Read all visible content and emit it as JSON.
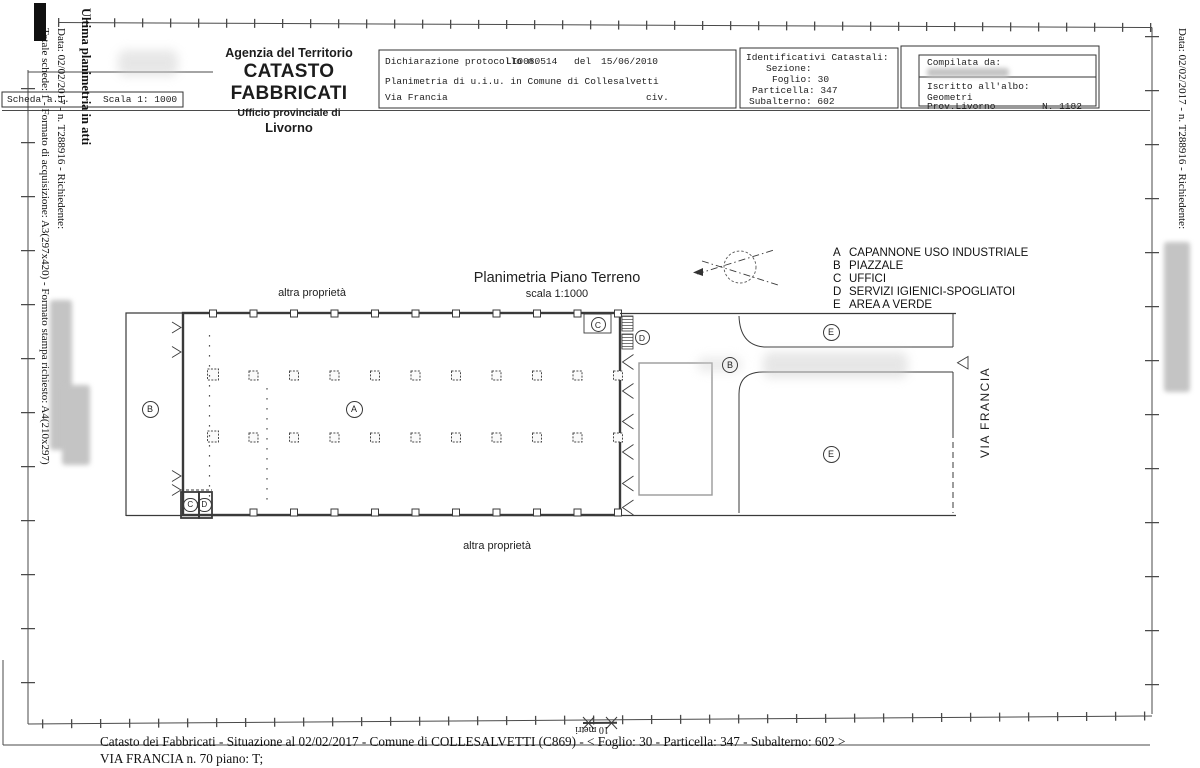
{
  "header": {
    "agency": "Agenzia del Territorio",
    "title": "CATASTO FABBRICATI",
    "office": "Ufficio provinciale di",
    "city": "Livorno"
  },
  "scheda": {
    "label": "Scheda a.1.",
    "scale": "Scala 1: 1000"
  },
  "declaration": {
    "protocol_label": "Dichiarazione protocollo n.",
    "protocol_number": "LI0080514",
    "del_label": "del",
    "date": "15/06/2010",
    "line2": "Planimetria di u.i.u. in Comune di Collesalvetti",
    "street": "Via Francia",
    "civ": "civ."
  },
  "identifiers": {
    "title": "Identificativi Catastali:",
    "sezione_label": "Sezione:",
    "foglio_label": "Foglio:",
    "foglio": "30",
    "particella_label": "Particella:",
    "particella": "347",
    "subalterno_label": "Subalterno:",
    "subalterno": "602"
  },
  "compiler": {
    "title": "Compilata da:",
    "albo_label": "Iscritto all'albo:",
    "albo": "Geometri",
    "prov": "Prov.Livorno",
    "number": "N. 1182"
  },
  "plan": {
    "title": "Planimetria Piano Terreno",
    "scale": "scala 1:1000",
    "other_property_top": "altra proprietà",
    "other_property_bottom": "altra proprietà",
    "street_label": "VIA FRANCIA",
    "scalebar_label": "10 metri",
    "labels": {
      "a": "A",
      "b": "B",
      "c": "C",
      "d": "D",
      "e": "E"
    }
  },
  "legend": {
    "items": [
      {
        "key": "A",
        "label": "CAPANNONE USO INDUSTRIALE"
      },
      {
        "key": "B",
        "label": "PIAZZALE"
      },
      {
        "key": "C",
        "label": "UFFICI"
      },
      {
        "key": "D",
        "label": "SERVIZI IGIENICI-SPOGLIATOI"
      },
      {
        "key": "E",
        "label": "AREA A VERDE"
      }
    ]
  },
  "margins": {
    "left_outer": "Totale schede: 1 - Formato di acquisizione: A3(297x420) - Formato stampa richiesto: A4(210x297)",
    "left_inner": "Data: 02/02/2017 - n. T288916 - Richiedente:",
    "left_bold": "Ultima planimetria in atti",
    "right": "Data: 02/02/2017 - n. T288916 - Richiedente:"
  },
  "footer": {
    "line1": "Catasto dei Fabbricati - Situazione al 02/02/2017 - Comune di COLLESALVETTI (C869) - <  Foglio: 30 - Particella: 347 - Subalterno: 602 >",
    "line2": "VIA FRANCIA n. 70 piano: T;"
  }
}
